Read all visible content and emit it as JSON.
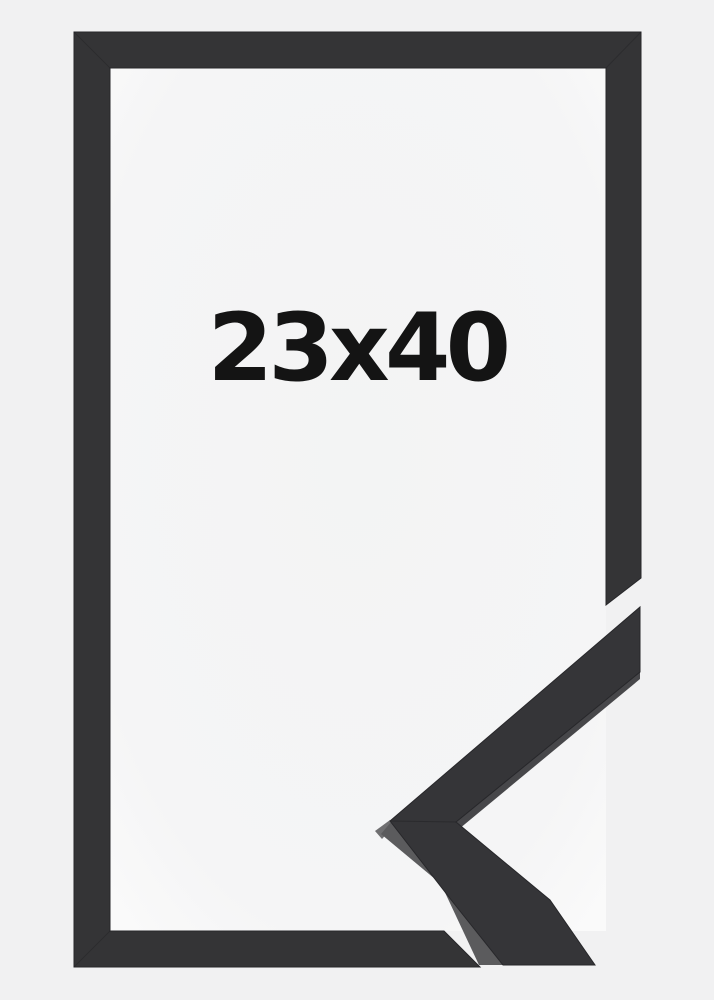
{
  "image": {
    "size_label": "23x40"
  },
  "colors": {
    "background": "#f1f1f2",
    "frame_interior_center": "#f3f4f4",
    "frame_interior_edge": "#fafafa",
    "frame": "#343436",
    "frame_edge": "#27272a",
    "seam": "#1c1c1f",
    "moulding_front": "#353538",
    "moulding_side": "#5b5b5d",
    "moulding_side_thin": "#47474a",
    "moulding_tip_face": "#6f6f71",
    "label_text": "#141414"
  }
}
